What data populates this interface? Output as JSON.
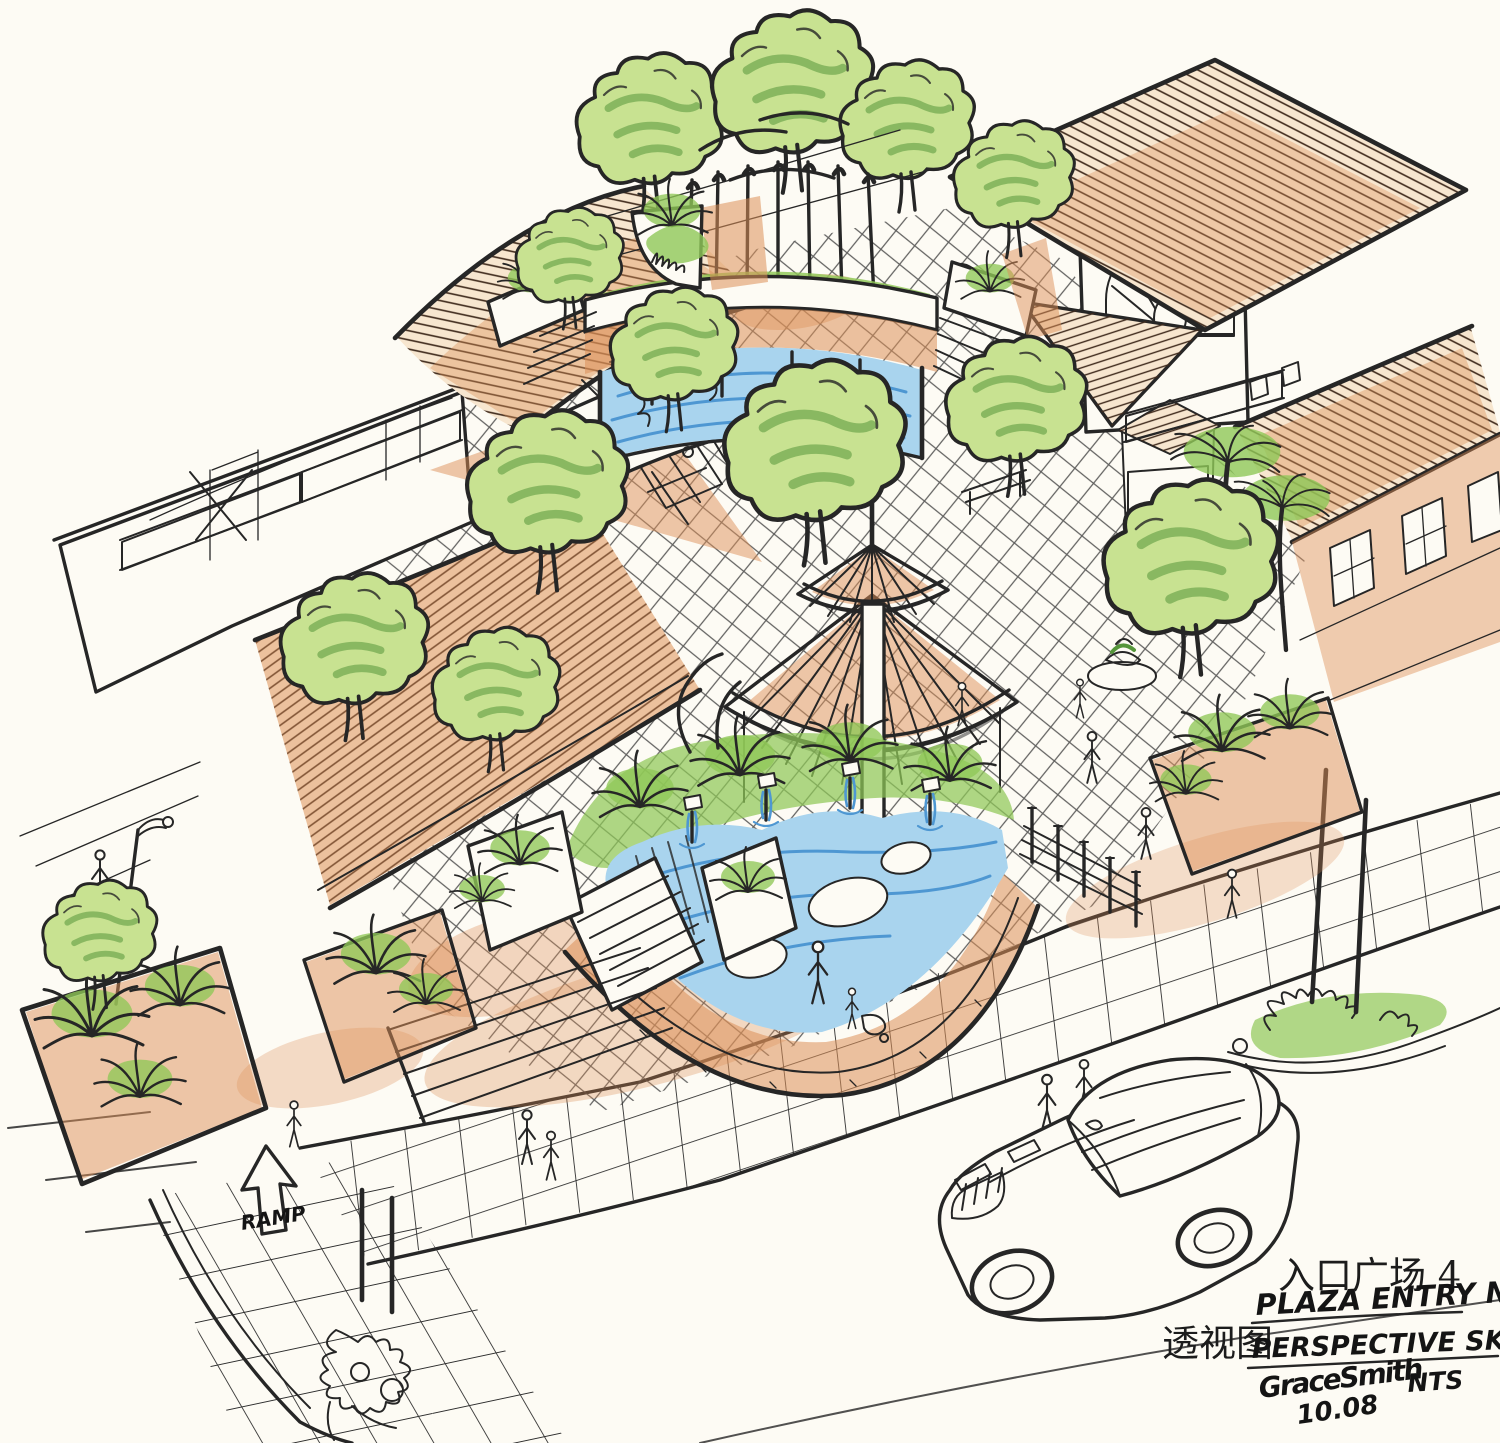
{
  "artwork": {
    "kind": "hand-drawn landscape architecture perspective sketch, ink with colored pencil",
    "scene": "entry plaza with raised palm fountain terrace, crescent pond with water jets, two-tier circular pavilion, diamond crosshatch paving, surrounding tile-roof buildings, street with sedan car and pedestrians"
  },
  "palette": {
    "paper": "#fdfbf4",
    "ink": "#262626",
    "ink_soft": "#4a4a4a",
    "terracotta": "#dd9058",
    "terracotta_deep": "#b85f33",
    "green_light": "#c8e291",
    "green_mid": "#8fc857",
    "green_dark": "#55963a",
    "water_light": "#a9d4ee",
    "water_deep": "#4e97d2"
  },
  "annotations": {
    "ramp_label": "RAMP",
    "title_cjk": "入口广场 4",
    "title_en": "PLAZA ENTRY NO#4",
    "view_label_cjk": "透视图",
    "view_label_en": "PERSPECTIVE SKETCH",
    "scale_note": "NTS",
    "signature": "GraceSmith",
    "date": "10.08"
  }
}
